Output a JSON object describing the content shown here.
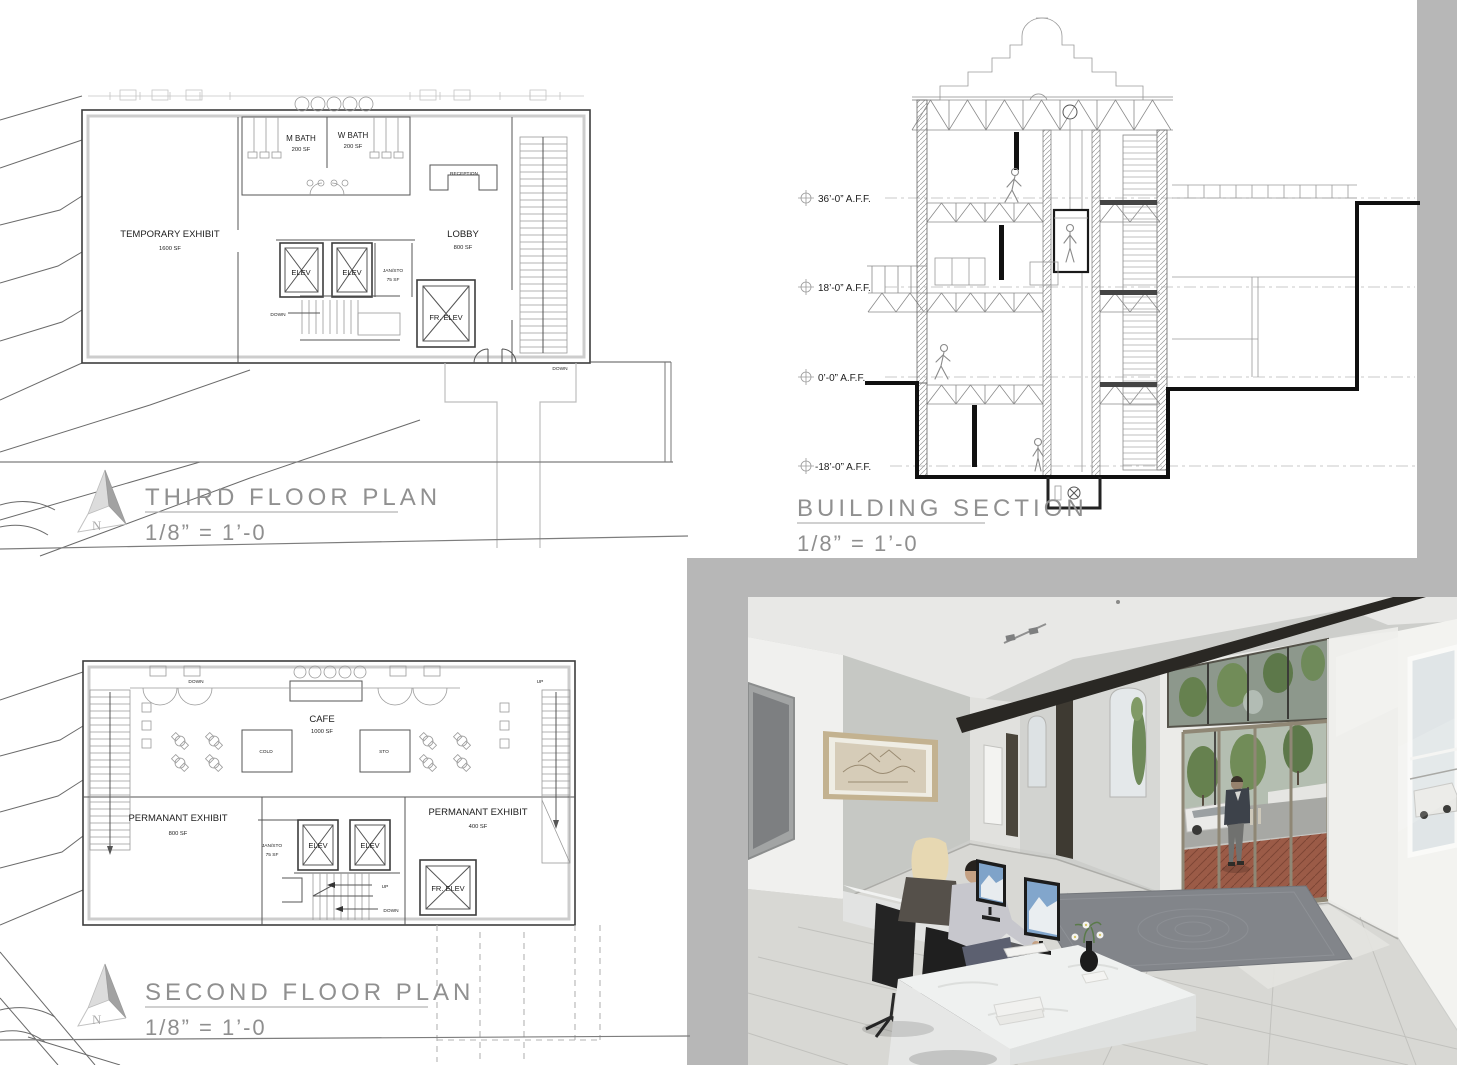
{
  "board": {
    "north_letter": "N",
    "titles": {
      "third": {
        "name": "THIRD FLOOR PLAN",
        "scale": "1/8” = 1’-0"
      },
      "second": {
        "name": "SECOND FLOOR PLAN",
        "scale": "1/8” = 1’-0"
      },
      "section": {
        "name": "BUILDING SECTION",
        "scale": "1/8” = 1’-0"
      }
    },
    "third_plan": {
      "temporary_exhibit": "TEMPORARY EXHIBIT",
      "temporary_exhibit_sf": "1600 SF",
      "m_bath": "M BATH",
      "m_bath_sf": "200 SF",
      "w_bath": "W BATH",
      "w_bath_sf": "200 SF",
      "reception": "RECEPTION",
      "lobby": "LOBBY",
      "lobby_sf": "800 SF",
      "elev_1": "ELEV",
      "elev_2": "ELEV",
      "jan_sto": "JAN/STO",
      "jan_sto_sf": "75 SF",
      "fr_elev": "FR. ELEV",
      "down_stair": "DOWN",
      "down_exit": "DOWN"
    },
    "second_plan": {
      "cafe": "CAFE",
      "cafe_sf": "1000 SF",
      "cold": "COLD",
      "sto": "STO",
      "perm_exhibit_left": "PERMANANT EXHIBIT",
      "perm_exhibit_left_sf": "800 SF",
      "perm_exhibit_right": "PERMANANT EXHIBIT",
      "perm_exhibit_right_sf": "400 SF",
      "jan_sto": "JAN/STO",
      "jan_sto_sf": "75 SF",
      "elev_1": "ELEV",
      "elev_2": "ELEV",
      "fr_elev": "FR. ELEV",
      "down_left": "DOWN",
      "up_right": "UP",
      "up_stair": "UP",
      "down_stair": "DOWN"
    },
    "section_view": {
      "levels": [
        {
          "label": "36’-0” A.F.F."
        },
        {
          "label": "18’-0” A.F.F."
        },
        {
          "label": "0’-0” A.F.F."
        },
        {
          "label": "-18’-0” A.F.F."
        }
      ]
    }
  },
  "colors": {
    "page_bg": "#ffffff",
    "panel_gray": "#b7b7b7",
    "title_gray": "#909090",
    "line_dark": "#3d3d3d",
    "profile_black": "#101010",
    "render_wall": "#c6c8c4",
    "render_beam": "#2a2824",
    "render_brick": "#9b5b47",
    "render_tree": "#6f8a5a",
    "render_rug": "#82858a",
    "render_desk": "#eff1f0"
  }
}
